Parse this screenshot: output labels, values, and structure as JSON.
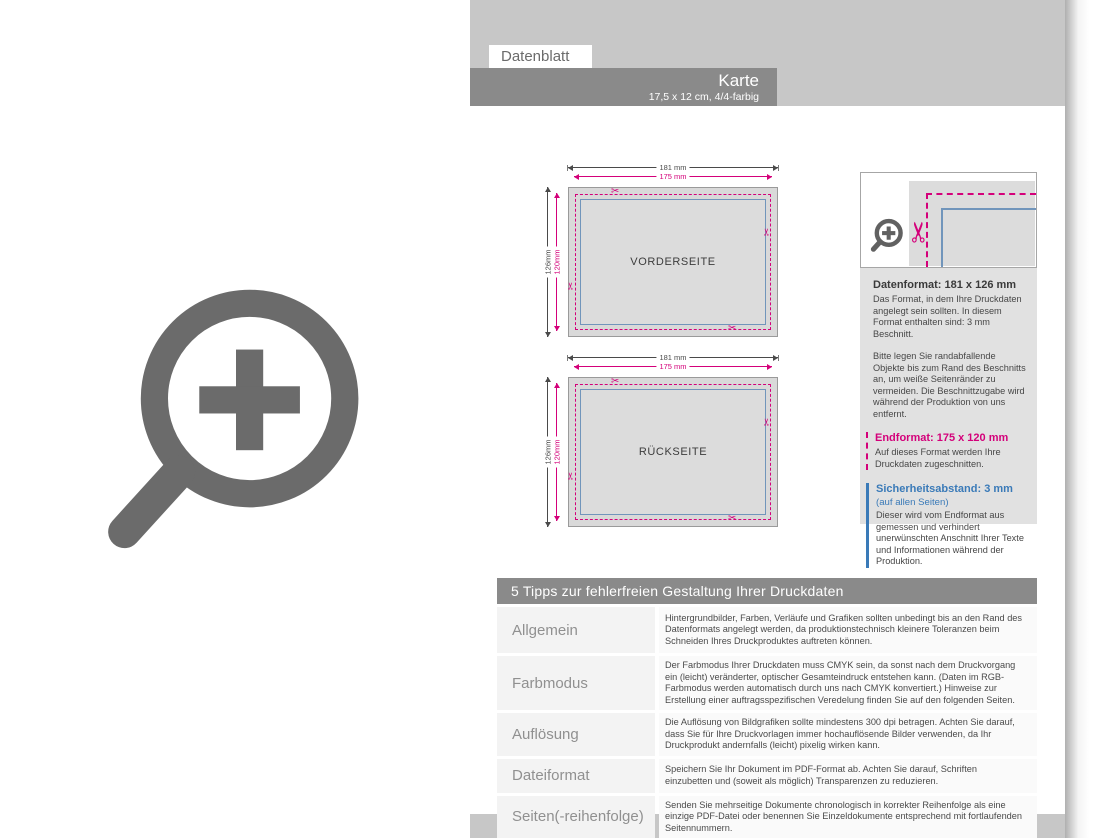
{
  "header": {
    "tab_label": "Datenblatt",
    "product_title": "Karte",
    "product_subtitle": "17,5 x 12 cm, 4/4-farbig"
  },
  "diagrams": {
    "front": {
      "label": "VORDERSEITE",
      "width_outer": "181 mm",
      "width_inner": "175 mm",
      "height_outer": "126mm",
      "height_inner": "120mm"
    },
    "back": {
      "label": "RÜCKSEITE",
      "width_outer": "181 mm",
      "width_inner": "175 mm",
      "height_outer": "126mm",
      "height_inner": "120mm"
    }
  },
  "info_panel": {
    "datenformat": {
      "title": "Datenformat: 181 x 126 mm",
      "p1": "Das Format, in dem Ihre Druckdaten angelegt sein sollten. In diesem Format enthalten sind: 3 mm Beschnitt.",
      "p2": "Bitte legen Sie randabfallende Objekte bis zum Rand des Beschnitts an, um weiße Seitenränder zu vermeiden. Die Beschnittzugabe wird während der Produktion von uns entfernt."
    },
    "endformat": {
      "title": "Endformat: 175 x 120 mm",
      "text": "Auf dieses Format werden Ihre Druckdaten zugeschnitten."
    },
    "sicherheitsabstand": {
      "title": "Sicherheitsabstand: 3 mm",
      "subtitle": "(auf allen Seiten)",
      "text": "Dieser wird vom Endformat aus gemessen und verhindert unerwünschten Anschnitt Ihrer Texte und Informationen während der Produktion."
    }
  },
  "tips_table": {
    "title": "5 Tipps zur fehlerfreien Gestaltung Ihrer Druckdaten",
    "rows": [
      {
        "label": "Allgemein",
        "text": "Hintergrundbilder, Farben, Verläufe und Grafiken sollten unbedingt bis an den Rand des Datenformats angelegt werden, da produktionstechnisch kleinere Toleranzen beim Schneiden Ihres Druckproduktes auftreten können."
      },
      {
        "label": "Farbmodus",
        "text": "Der Farbmodus Ihrer Druckdaten muss CMYK sein, da sonst nach dem Druckvorgang ein (leicht) veränderter, optischer Gesamteindruck entstehen kann. (Daten im RGB-Farbmodus werden automatisch durch uns nach CMYK konvertiert.) Hinweise zur Erstellung einer auftragsspezifischen Veredelung finden Sie auf den folgenden Seiten."
      },
      {
        "label": "Auflösung",
        "text": "Die Auflösung von Bildgrafiken sollte mindestens 300 dpi betragen. Achten Sie darauf, dass Sie für Ihre Druckvorlagen immer hochauflösende Bilder verwenden, da Ihr Druckprodukt andernfalls (leicht) pixelig wirken kann."
      },
      {
        "label": "Dateiformat",
        "text": "Speichern Sie Ihr Dokument im PDF-Format ab. Achten Sie darauf, Schriften einzubetten und (soweit als möglich) Transparenzen zu reduzieren."
      },
      {
        "label": "Seiten(-reihenfolge)",
        "text": "Senden Sie mehrseitige Dokumente chronologisch in korrekter Reihenfolge als eine einzige PDF-Datei oder benennen Sie Einzeldokumente entsprechend mit fortlaufenden Seitennummern."
      }
    ]
  },
  "icons": {
    "scissors": "✂"
  },
  "colors": {
    "cut_magenta": "#d4007a",
    "safety_blue": "#3a7ab8",
    "bar_gray": "#8a8a8a",
    "page_gray": "#c7c7c7"
  }
}
